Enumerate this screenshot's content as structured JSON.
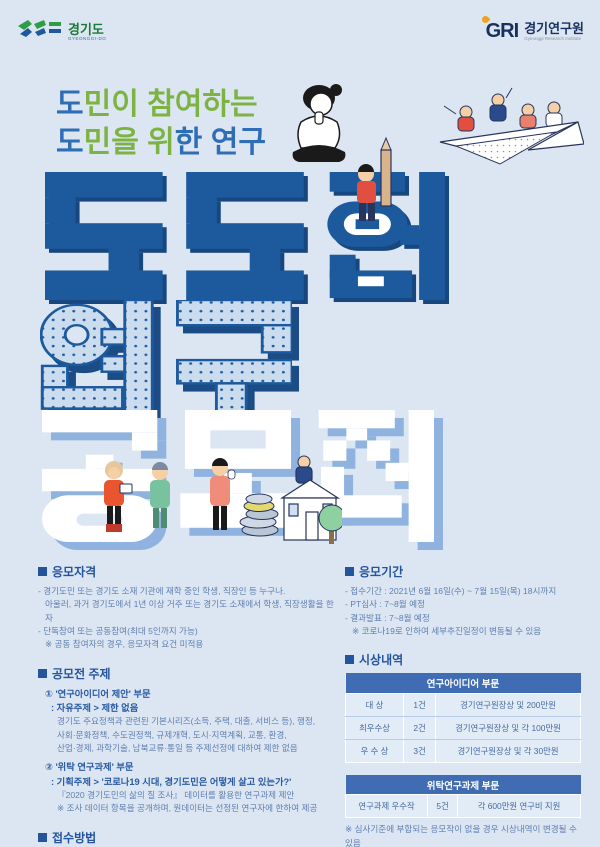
{
  "header": {
    "gyeonggi_logo": {
      "korean": "경기도",
      "english": "GYEONGGI-DO"
    },
    "gri_logo": {
      "acronym": "GRI",
      "korean": "경기연구원",
      "english": "Gyeonggi Research Institute"
    }
  },
  "title": {
    "script_lines": [
      {
        "text": "도민이 참여하는",
        "blue_indices": [
          0
        ]
      },
      {
        "text": "도민을 위한 연구",
        "blue_indices": [
          0,
          5,
          7,
          8
        ]
      }
    ],
    "main_words": [
      "도도한",
      "연구",
      "공모전"
    ],
    "colors": {
      "navy": "#1d5a9d",
      "dot_fill": "#cbdcef",
      "white": "#ffffff",
      "shadow_periwinkle": "#8fb3de",
      "green": "#7db343",
      "blue": "#2f6eb5"
    }
  },
  "icons": {
    "thinking_person": "person sitting cross-legged thinking",
    "pencil_person": "person in red shirt holding giant pencil",
    "paper_plane": "four people riding a paper airplane",
    "street_scene": "people, coins, house and tree"
  },
  "sections": {
    "eligibility": {
      "title": "응모자격",
      "lines": [
        "- 경기도민 또는 경기도 소재 기관에 재학 중인 학생, 직장인 등 누구나.",
        "아울러, 과거 경기도에서 1년 이상 거주 또는 경기도 소재에서 학생, 직장생활을 한 자",
        "- 단독참여 또는 공동참여(최대 5인까지 가능)",
        "※ 공동 참여자의 경우, 응모자격 요건 미적용"
      ]
    },
    "topics": {
      "title": "공모전 주제",
      "item1_title": "① '연구아이디어 제안' 부문",
      "item1_sub": ": 자유주제 > 제한 없음",
      "item1_body1": "경기도 주요정책과 관련된 기본시리즈(소득, 주택, 대출, 서비스 등), 행정,",
      "item1_body2": "사회·문화정책, 수도권정책, 규제개혁, 도시·지역계획, 교통, 환경,",
      "item1_body3": "산업·경제, 과학기술, 남북교류·통일 등 주제선정에 대하여 제한 없음",
      "item2_title": "② '위탁 연구과제' 부문",
      "item2_sub": ": 기획주제 > '코로나19 시대, 경기도민은 어떻게 살고 있는가?'",
      "item2_body1": "『2020 경기도민의 삶의 질 조사』 데이터를 활용한 연구과제 제안",
      "item2_body2": "※ 조사 데이터 항목을 공개하며, 원데이터는 선정된 연구자에 한하여 제공"
    },
    "apply": {
      "title": "접수방법",
      "line1": "- 이메일 접수 : gri1004@gri.re.kr"
    },
    "period": {
      "title": "응모기간",
      "lines": [
        "- 접수기간 : 2021년 6월 16일(수) ~ 7월 15일(목) 18시까지",
        "- PT심사 : 7~8월 예정",
        "- 결과발표 : 7~8월 예정",
        "※ 코로나19로 인하여 세부추진일정이 변동될 수 있음"
      ]
    },
    "awards": {
      "title": "시상내역",
      "idea_table": {
        "header": "연구아이디어 부문",
        "rows": [
          {
            "grade": "대  상",
            "count": "1건",
            "prize": "경기연구원장상 및 200만원"
          },
          {
            "grade": "최우수상",
            "count": "2건",
            "prize": "경기연구원장상 및 각 100만원"
          },
          {
            "grade": "우 수 상",
            "count": "3건",
            "prize": "경기연구원장상 및 각 30만원"
          }
        ]
      },
      "research_table": {
        "header": "위탁연구과제 부문",
        "rows": [
          {
            "grade": "연구과제 우수작",
            "count": "5건",
            "prize": "각 600만원 연구비 지원"
          }
        ]
      },
      "note": "※ 심사기준에 부합되는 응모작이 없을 경우 시상내역이 변경될 수 있음"
    },
    "contact": {
      "title": "문의사항",
      "text": "경기연구원 연구기획부 031)250-3249 / 3227"
    }
  }
}
